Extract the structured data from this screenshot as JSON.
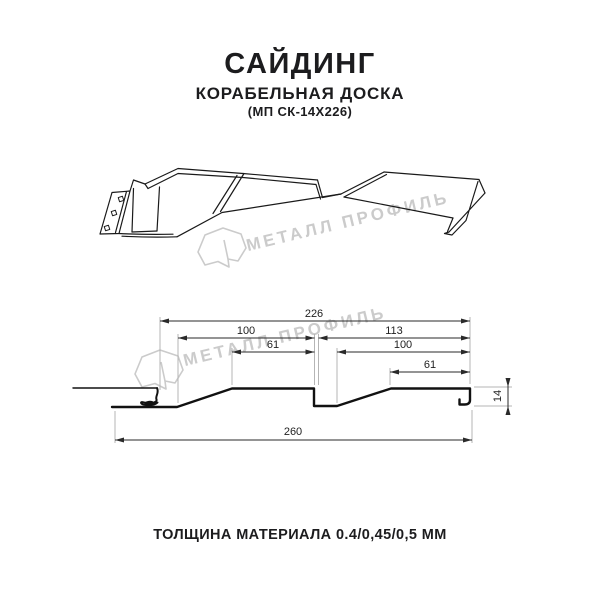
{
  "header": {
    "title": "САЙДИНГ",
    "subtitle": "КОРАБЕЛЬНАЯ ДОСКА",
    "model": "(МП СК-14Х226)"
  },
  "footer": {
    "thickness": "ТОЛЩИНА МАТЕРИАЛА 0.4/0,45/0,5 ММ"
  },
  "watermark": {
    "text": "МЕТАЛЛ ПРОФИЛЬ",
    "color": "#cbcbcb"
  },
  "dimensions": {
    "overall_top": "226",
    "pitch_left": "100",
    "flat_left": "61",
    "segment_right": "113",
    "pitch_right": "100",
    "flat_right": "61",
    "overall_bottom": "260",
    "height": "14",
    "units": "mm"
  },
  "colors": {
    "background": "#ffffff",
    "line": "#1a1a1a",
    "profile": "#111111",
    "dimension": "#2a2a2a",
    "extension": "#b5b5b5",
    "text": "#1c1c1e",
    "watermark": "#cbcbcb"
  }
}
